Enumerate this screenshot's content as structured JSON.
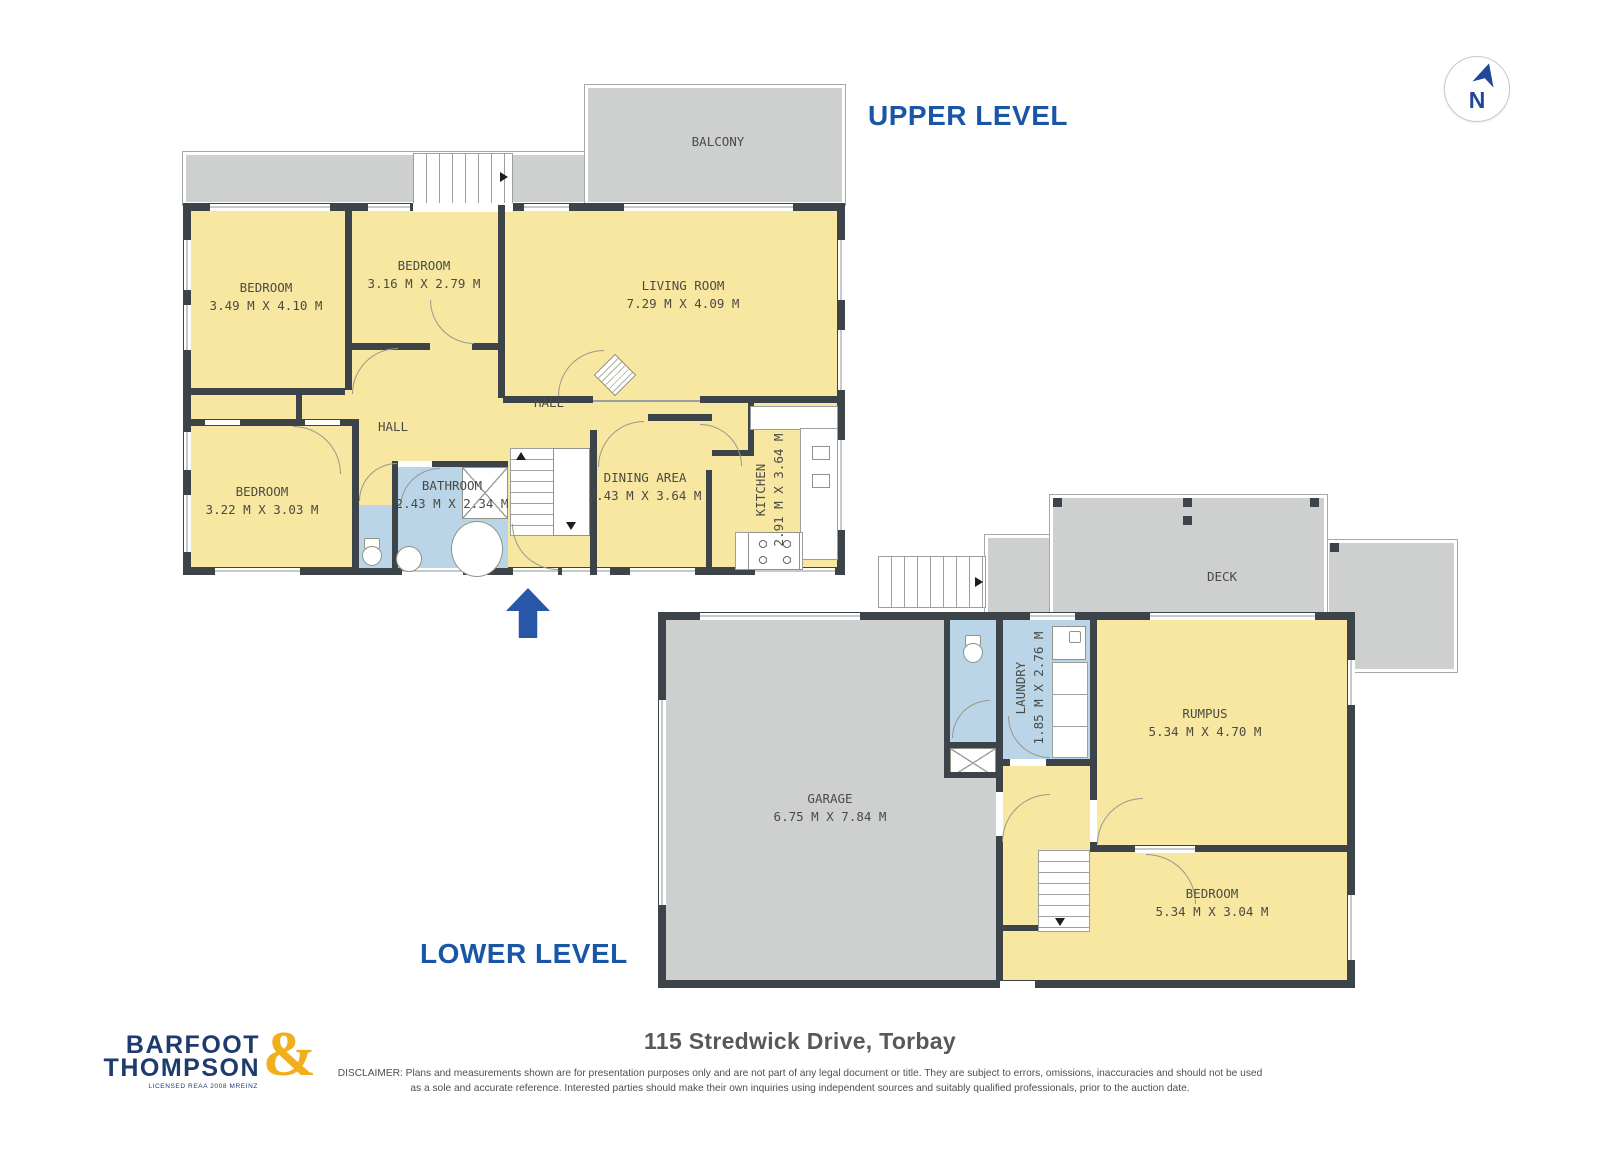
{
  "titles": {
    "upper": "UPPER LEVEL",
    "lower": "LOWER LEVEL"
  },
  "compass": {
    "label": "N"
  },
  "upper_level": {
    "balcony_label": "BALCONY",
    "halls": [
      "HALL",
      "HALL"
    ],
    "rooms": {
      "bedroom_left": {
        "name": "BEDROOM",
        "dims": "3.49 M X 4.10 M"
      },
      "bedroom_mid": {
        "name": "BEDROOM",
        "dims": "3.16 M X 2.79 M"
      },
      "living_room": {
        "name": "LIVING ROOM",
        "dims": "7.29 M X 4.09 M"
      },
      "bedroom_lower": {
        "name": "BEDROOM",
        "dims": "3.22 M X 3.03 M"
      },
      "bathroom": {
        "name": "BATHROOM",
        "dims": "2.43 M X 2.34 M"
      },
      "dining": {
        "name": "DINING AREA",
        "dims": "2.43 M X 3.64 M"
      },
      "kitchen": {
        "name": "KITCHEN",
        "dims": "2.91 M X 3.64 M"
      }
    }
  },
  "lower_level": {
    "deck_label": "DECK",
    "rooms": {
      "garage": {
        "name": "GARAGE",
        "dims": "6.75 M X 7.84 M"
      },
      "laundry": {
        "name": "LAUNDRY",
        "dims": "1.85 M X 2.76 M"
      },
      "rumpus": {
        "name": "RUMPUS",
        "dims": "5.34 M X 4.70 M"
      },
      "bedroom": {
        "name": "BEDROOM",
        "dims": "5.34 M X 3.04 M"
      }
    }
  },
  "footer": {
    "logo": {
      "line1": "BARFOOT",
      "line2": "THOMPSON",
      "ampersand": "&",
      "tagline": "LICENSED REAA 2008 MREINZ"
    },
    "address": "115 Stredwick Drive, Torbay",
    "disclaimer1": "DISCLAIMER: Plans and measurements shown are for presentation purposes only and are not part of any legal document or title. They are subject to errors, omissions, inaccuracies and should not be used",
    "disclaimer2": "as a sole and accurate reference. Interested parties should make their own inquiries using independent sources and suitably qualified professionals, prior to the auction date."
  },
  "colors": {
    "accent_blue": "#1957a6",
    "logo_navy": "#1e3a6e",
    "logo_gold": "#f0b01e",
    "room_yellow": "#f8e7a1",
    "wet_blue": "#b9d5e7",
    "surface_gray": "#cdd0cf",
    "wall_dark": "#3d4449",
    "arrow_blue": "#2857a8"
  }
}
